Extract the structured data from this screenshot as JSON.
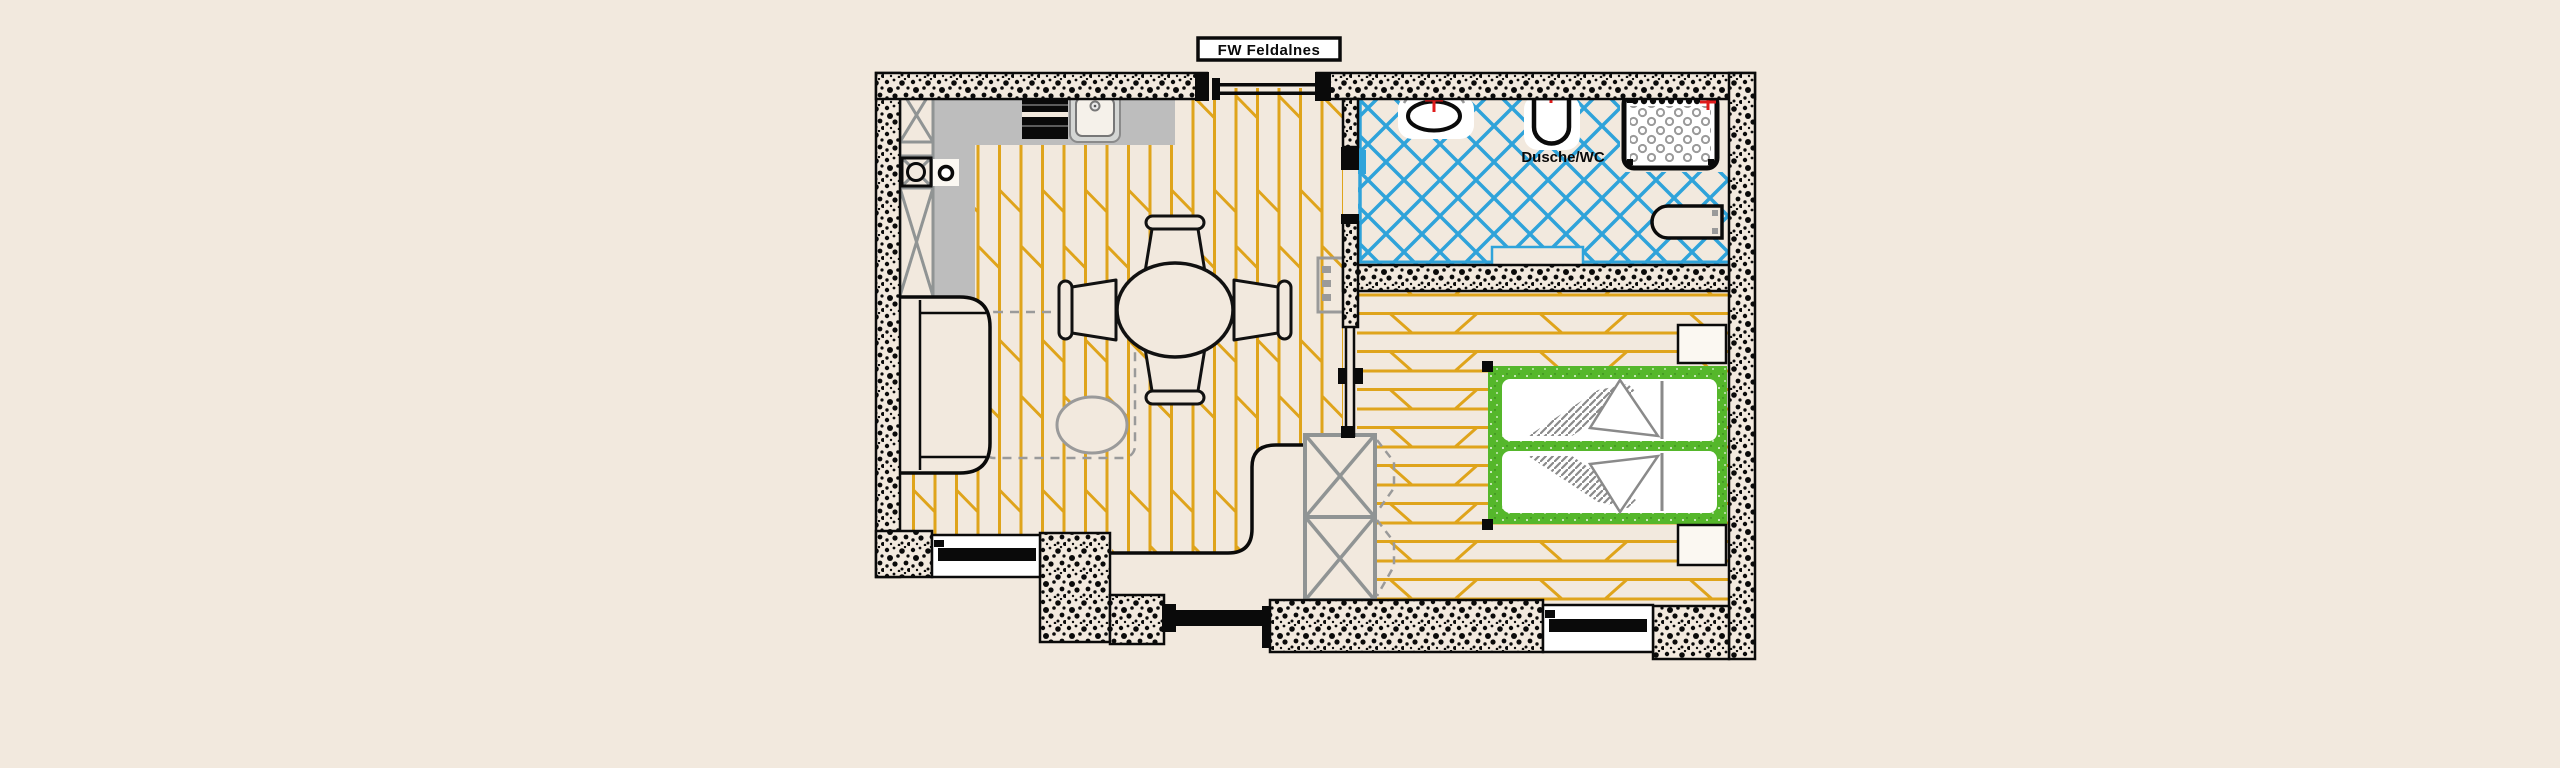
{
  "title": {
    "text": "FW Feldalnes"
  },
  "labels": {
    "bathroom": "Dusche/WC"
  },
  "colors": {
    "background": "#F2E9DE",
    "wall_ink": "#0a0a0a",
    "floor_plank_orange": "#DFA41B",
    "bathroom_tile_blue": "#2FA3DA",
    "bed_frame_green": "#55B72B",
    "counter_gray": "#BDBDBD",
    "furniture_gray": "#909494",
    "soft_gray": "#9a9a9a",
    "accent_red": "#E01B1B"
  }
}
